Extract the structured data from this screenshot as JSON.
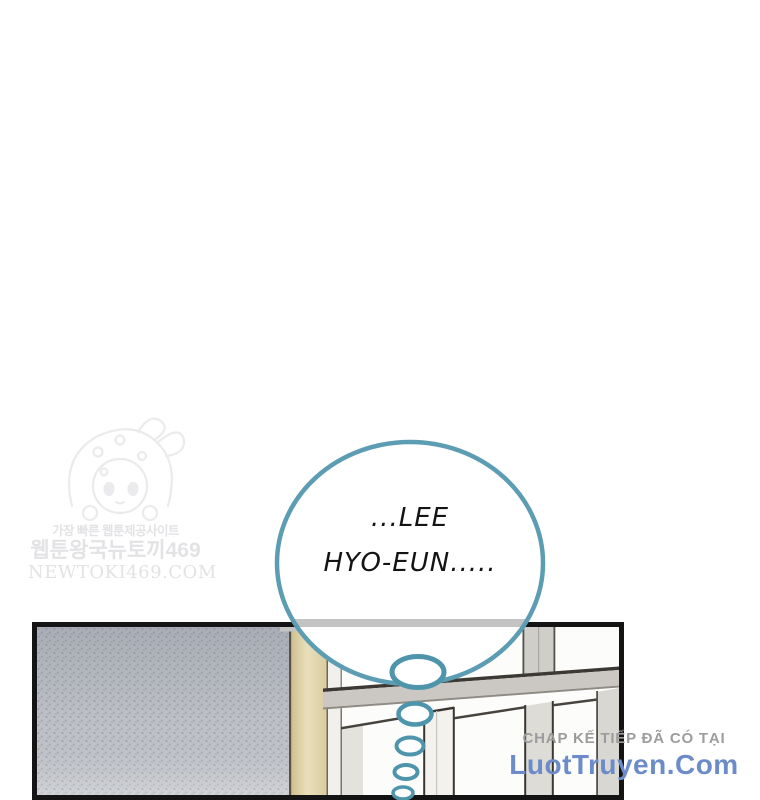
{
  "page": {
    "background_color": "#ffffff",
    "type": "webtoon-comic-page"
  },
  "watermark_newtoki": {
    "line1": "가장 빠른 웹툰제공사이트",
    "line2": "웹툰왕국뉴토끼469",
    "line3": "NEWTOKI469.COM",
    "text_color": "#e3e3e6",
    "mascot_icon": "bunny-hood-chibi-sketch"
  },
  "speech_bubble": {
    "lines": [
      "...LEE",
      "HYO-EUN....."
    ],
    "full_text": "...LEE HYO-EUN.....",
    "fill_color": "#ffffff",
    "border_color": "#5c9db3",
    "text_color": "#141414",
    "thought_trail_bubble_count": 5
  },
  "panel": {
    "border_color": "#141414",
    "wall_color": "#c2c4c9",
    "wall_speckle_color": "#8e939e",
    "trim_wood_color": "#ddc795",
    "window_muntin_color": "#cbc8c3",
    "window_pane_color": "#fcfcfa",
    "outline_color": "#3c3833"
  },
  "footer_watermark": {
    "line1": "CHAP KẾ TIẾP ĐÃ CÓ TẠI",
    "line1_color": "#9c9c9c",
    "line2": "LuotTruyen.Com",
    "line2_color": "#6b8cc8"
  }
}
